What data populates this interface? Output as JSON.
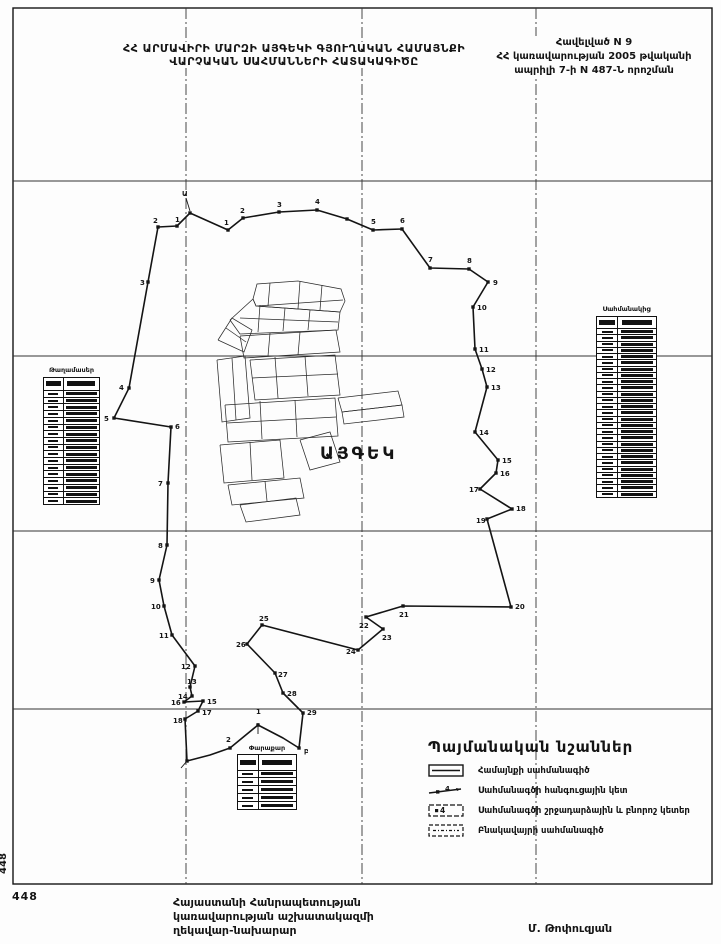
{
  "header": {
    "title_line1": "ՀՀ ԱՐՄԱՎԻՐԻ ՄԱՐԶԻ ԱՅԳԵԿԻ ԳՅՈՒՂԱԿԱՆ ՀԱՄԱՅՆՔԻ",
    "title_line2": "ՎԱՐՉԱԿԱՆ ՍԱՀՄԱՆՆԵՐԻ ՀԱՏԱԿԱԳԻԾԸ"
  },
  "appendix": {
    "line1": "Հավելված N 9",
    "line2": "ՀՀ կառավարության 2005 թվականի",
    "line3": "ապրիլի 7-ի N 487-Ն որոշման"
  },
  "map": {
    "settlement_label": "ԱՅԳԵԿ",
    "grid": {
      "frame": {
        "x": 13,
        "y": 8,
        "w": 699,
        "h": 876
      },
      "verticals": [
        186,
        362,
        536
      ],
      "horizontals": [
        181,
        356,
        531,
        709
      ]
    },
    "boundary": {
      "path": [
        [
          190,
          213
        ],
        [
          228,
          230
        ],
        [
          243,
          218
        ],
        [
          279,
          212
        ],
        [
          317,
          210
        ],
        [
          347,
          219
        ],
        [
          373,
          230
        ],
        [
          402,
          229
        ],
        [
          430,
          268
        ],
        [
          469,
          269
        ],
        [
          488,
          282
        ],
        [
          473,
          307
        ],
        [
          475,
          349
        ],
        [
          482,
          369
        ],
        [
          487,
          387
        ],
        [
          475,
          432
        ],
        [
          498,
          460
        ],
        [
          496,
          473
        ],
        [
          480,
          489
        ],
        [
          512,
          509
        ],
        [
          487,
          519
        ],
        [
          511,
          607
        ],
        [
          403,
          606
        ],
        [
          366,
          617
        ],
        [
          383,
          629
        ],
        [
          358,
          650
        ],
        [
          262,
          625
        ],
        [
          247,
          644
        ],
        [
          275,
          673
        ],
        [
          283,
          693
        ],
        [
          303,
          713
        ],
        [
          299,
          748
        ],
        [
          283,
          738
        ],
        [
          258,
          725
        ],
        [
          230,
          748
        ],
        [
          210,
          755
        ],
        [
          187,
          761
        ],
        [
          185,
          719
        ],
        [
          198,
          711
        ],
        [
          203,
          701
        ],
        [
          184,
          702
        ],
        [
          192,
          696
        ],
        [
          190,
          687
        ],
        [
          195,
          666
        ],
        [
          172,
          635
        ],
        [
          164,
          606
        ],
        [
          159,
          580
        ],
        [
          167,
          545
        ],
        [
          168,
          483
        ],
        [
          171,
          427
        ],
        [
          114,
          418
        ],
        [
          129,
          388
        ],
        [
          148,
          282
        ],
        [
          158,
          227
        ],
        [
          177,
          226
        ],
        [
          190,
          213
        ]
      ],
      "points": [
        {
          "x": 190,
          "y": 213,
          "n": "Ա",
          "dx": -8,
          "dy": -17
        },
        {
          "x": 228,
          "y": 230,
          "n": "1",
          "dx": -4,
          "dy": -5
        },
        {
          "x": 243,
          "y": 218,
          "n": "2",
          "dx": -3,
          "dy": -5
        },
        {
          "x": 279,
          "y": 212,
          "n": "3",
          "dx": -2,
          "dy": -5
        },
        {
          "x": 317,
          "y": 210,
          "n": "4",
          "dx": -2,
          "dy": -6
        },
        {
          "x": 373,
          "y": 230,
          "n": "5",
          "dx": -2,
          "dy": -6
        },
        {
          "x": 402,
          "y": 229,
          "n": "6",
          "dx": -2,
          "dy": -6
        },
        {
          "x": 430,
          "y": 268,
          "n": "7",
          "dx": -2,
          "dy": -6
        },
        {
          "x": 469,
          "y": 269,
          "n": "8",
          "dx": -2,
          "dy": -6
        },
        {
          "x": 488,
          "y": 282,
          "n": "9",
          "dx": 5,
          "dy": 3
        },
        {
          "x": 473,
          "y": 307,
          "n": "10",
          "dx": 4,
          "dy": 3
        },
        {
          "x": 475,
          "y": 349,
          "n": "11",
          "dx": 4,
          "dy": 3
        },
        {
          "x": 482,
          "y": 369,
          "n": "12",
          "dx": 4,
          "dy": 3
        },
        {
          "x": 487,
          "y": 387,
          "n": "13",
          "dx": 4,
          "dy": 3
        },
        {
          "x": 475,
          "y": 432,
          "n": "14",
          "dx": 4,
          "dy": 3
        },
        {
          "x": 498,
          "y": 460,
          "n": "15",
          "dx": 4,
          "dy": 3
        },
        {
          "x": 496,
          "y": 473,
          "n": "16",
          "dx": 4,
          "dy": 3
        },
        {
          "x": 480,
          "y": 489,
          "n": "17",
          "dx": -11,
          "dy": 3
        },
        {
          "x": 512,
          "y": 509,
          "n": "18",
          "dx": 4,
          "dy": 2
        },
        {
          "x": 487,
          "y": 519,
          "n": "19",
          "dx": -11,
          "dy": 4
        },
        {
          "x": 511,
          "y": 607,
          "n": "20",
          "dx": 4,
          "dy": 2
        },
        {
          "x": 403,
          "y": 606,
          "n": "21",
          "dx": -4,
          "dy": 11
        },
        {
          "x": 366,
          "y": 617,
          "n": "22",
          "dx": -7,
          "dy": 11
        },
        {
          "x": 383,
          "y": 629,
          "n": "23",
          "dx": -1,
          "dy": 11
        },
        {
          "x": 358,
          "y": 650,
          "n": "24",
          "dx": -12,
          "dy": 4
        },
        {
          "x": 262,
          "y": 625,
          "n": "25",
          "dx": -3,
          "dy": -4
        },
        {
          "x": 247,
          "y": 644,
          "n": "26",
          "dx": -11,
          "dy": 3
        },
        {
          "x": 275,
          "y": 673,
          "n": "27",
          "dx": 3,
          "dy": 4
        },
        {
          "x": 283,
          "y": 693,
          "n": "28",
          "dx": 4,
          "dy": 3
        },
        {
          "x": 303,
          "y": 713,
          "n": "29",
          "dx": 4,
          "dy": 2
        },
        {
          "x": 299,
          "y": 748,
          "n": "բ",
          "dx": 5,
          "dy": 5
        },
        {
          "x": 258,
          "y": 725,
          "n": "1",
          "dx": -2,
          "dy": -11
        },
        {
          "x": 230,
          "y": 748,
          "n": "2",
          "dx": -4,
          "dy": -6
        },
        {
          "x": 177,
          "y": 226,
          "n": "1",
          "dx": -2,
          "dy": -4
        },
        {
          "x": 158,
          "y": 227,
          "n": "2",
          "dx": -5,
          "dy": -4
        },
        {
          "x": 148,
          "y": 282,
          "n": "3",
          "dx": -8,
          "dy": 3
        },
        {
          "x": 129,
          "y": 388,
          "n": "4",
          "dx": -10,
          "dy": 2
        },
        {
          "x": 114,
          "y": 418,
          "n": "5",
          "dx": -10,
          "dy": 3
        },
        {
          "x": 171,
          "y": 427,
          "n": "6",
          "dx": 4,
          "dy": 2
        },
        {
          "x": 168,
          "y": 483,
          "n": "7",
          "dx": -10,
          "dy": 3
        },
        {
          "x": 167,
          "y": 545,
          "n": "8",
          "dx": -9,
          "dy": 3
        },
        {
          "x": 159,
          "y": 580,
          "n": "9",
          "dx": -9,
          "dy": 3
        },
        {
          "x": 164,
          "y": 606,
          "n": "10",
          "dx": -13,
          "dy": 3
        },
        {
          "x": 172,
          "y": 635,
          "n": "11",
          "dx": -13,
          "dy": 3
        },
        {
          "x": 195,
          "y": 666,
          "n": "12",
          "dx": -14,
          "dy": 3
        },
        {
          "x": 190,
          "y": 687,
          "n": "13",
          "dx": -3,
          "dy": -3
        },
        {
          "x": 192,
          "y": 696,
          "n": "14",
          "dx": -14,
          "dy": 3
        },
        {
          "x": 203,
          "y": 701,
          "n": "15",
          "dx": 4,
          "dy": 3
        },
        {
          "x": 184,
          "y": 702,
          "n": "16",
          "dx": -13,
          "dy": 3
        },
        {
          "x": 198,
          "y": 711,
          "n": "17",
          "dx": 4,
          "dy": 4
        },
        {
          "x": 185,
          "y": 719,
          "n": "18",
          "dx": -12,
          "dy": 4
        }
      ],
      "extra_dots": [
        [
          187,
          761
        ],
        [
          347,
          219
        ]
      ],
      "leaders": [
        [
          186,
          198,
          190,
          211
        ],
        [
          258,
          734,
          258,
          723
        ],
        [
          187,
          761,
          181,
          768
        ]
      ]
    },
    "parcels": [
      "253,299 257,284 298,281 341,289 345,301 340,312 256,306 253,299",
      "257,306 343,300",
      "270,283 268,306",
      "300,281 298,309",
      "322,285 320,310",
      "230,320 253,299 256,306 340,312 338,330 240,334 230,320",
      "240,318 338,322",
      "260,305 258,332",
      "285,308 283,331",
      "310,310 308,330",
      "218,340 232,318 252,330 244,352 218,340",
      "226,328 246,342",
      "240,336 336,330 340,352 244,358 240,336",
      "270,333 268,356",
      "300,332 298,355",
      "217,360 245,356 250,418 222,422 217,360",
      "232,358 236,420",
      "250,360 335,355 340,395 255,400 250,360",
      "275,357 278,398",
      "305,356 308,396",
      "252,378 338,374",
      "338,398 398,391 402,405 342,412 338,398",
      "342,412 402,405 404,417 344,424 342,412",
      "225,405 335,398 338,436 228,442 225,405",
      "260,401 262,439",
      "295,400 297,437",
      "227,423 336,417",
      "220,445 280,440 284,478 224,483 220,445",
      "250,442 252,480",
      "228,485 300,478 304,498 232,505 228,485",
      "265,481 267,501",
      "300,440 330,432 340,462 310,470 300,440",
      "240,505 296,498 300,515 246,522 240,505"
    ]
  },
  "tables": {
    "left": {
      "title": "Թաղամասեր",
      "rows": 17
    },
    "right": {
      "title": "Սահմանակից",
      "rows": 27
    },
    "bottom": {
      "title": "Փարաքար",
      "rows": 5
    }
  },
  "legend": {
    "title": "Պայմանական նշաններ",
    "items": [
      {
        "icon": "community-boundary-line-icon",
        "label": "Համայնքի սահմանագիծ"
      },
      {
        "icon": "junction-point-icon",
        "label": "Սահմանագծի հանգուցային կետ"
      },
      {
        "icon": "turning-point-icon",
        "label": "Սահմանագծի շրջադարձային և բնորոշ կետեր"
      },
      {
        "icon": "settlement-boundary-line-icon",
        "label": "Բնակավայրի սահմանագիծ"
      }
    ]
  },
  "footer": {
    "org_line1": "Հայաստանի Հանրապետության",
    "org_line2": "կառավարության աշխատակազմի",
    "org_line3": "ղեկավար-նախարար",
    "signature": "Մ. Թոփուզյան"
  },
  "page": {
    "side_number": "448",
    "corner_number": "448"
  },
  "colors": {
    "ink": "#141414",
    "paper": "#fdfdfd"
  }
}
